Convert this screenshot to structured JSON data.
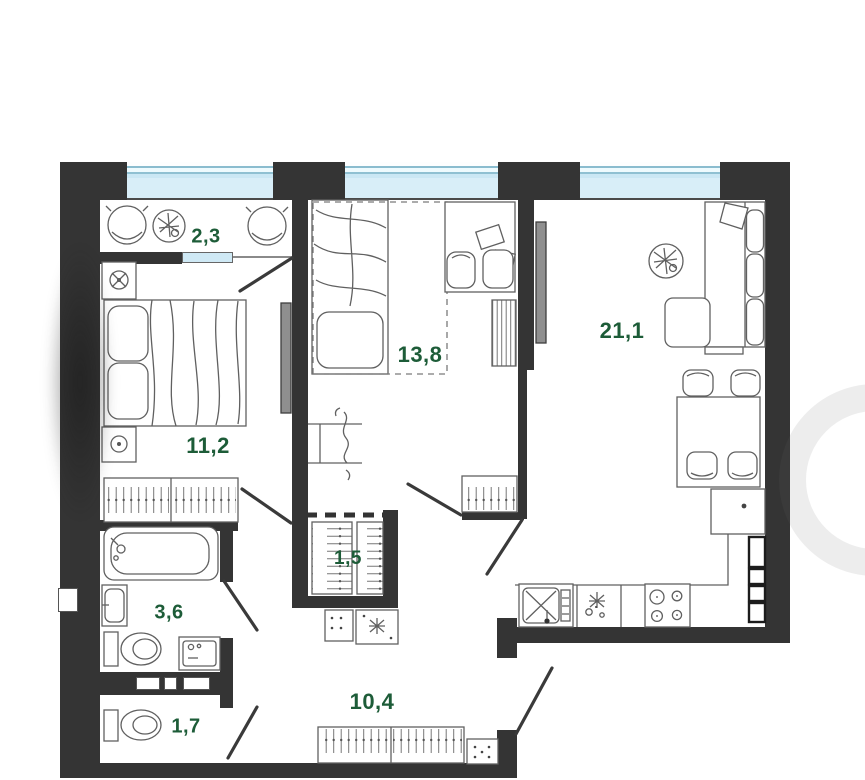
{
  "plan_title": "apartment floor plan",
  "colors": {
    "room_label": "#1d5c38",
    "wall": "#343434",
    "window_glass": "#d8eef8"
  },
  "rooms": {
    "loggia": {
      "area": "2,3"
    },
    "bedroom": {
      "area": "11,2"
    },
    "bedroom2": {
      "area": "13,8"
    },
    "living_kitchen": {
      "area": "21,1"
    },
    "closet": {
      "area": "1,5"
    },
    "bathroom": {
      "area": "3,6"
    },
    "hallway": {
      "area": "10,4"
    },
    "wc": {
      "area": "1,7"
    }
  }
}
